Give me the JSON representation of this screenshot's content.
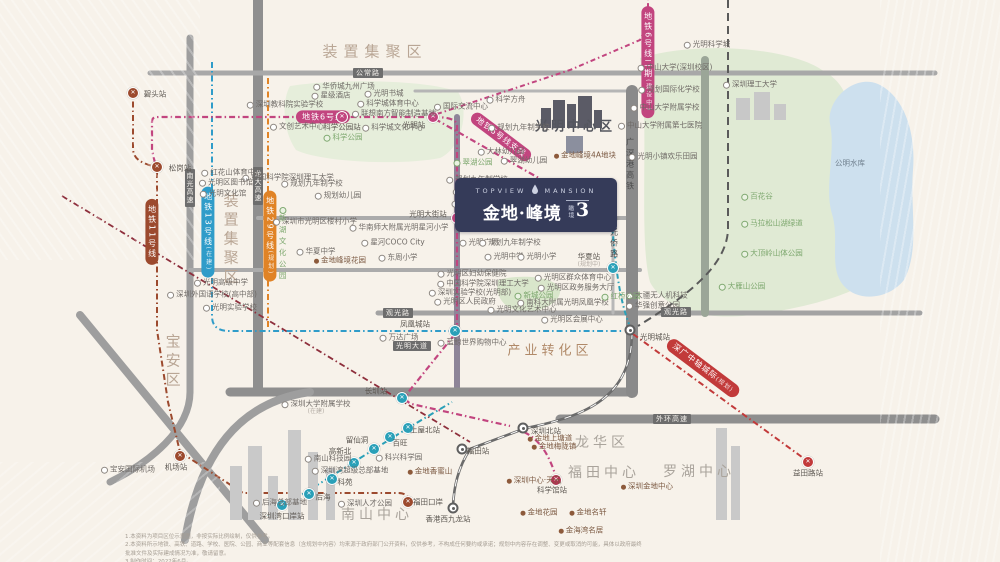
{
  "palette": {
    "background": "#f7f2ea",
    "green": "#e0ead4",
    "lake": "#cde0ee",
    "road": "#a0a0a0",
    "line6_pink": "#c2457f",
    "line13_blue": "#2f9cc9",
    "line29_orange": "#e08326",
    "line11_brown": "#9c4a2e",
    "teal": "#2aa0b8",
    "city_rail_red": "#c23a3a",
    "dark_red": "#8e2f3c",
    "rail_gray": "#6b6b6b",
    "logo_navy": "#353b59"
  },
  "logo": {
    "en_left": "TOPVIEW",
    "en_right": "MANSION",
    "cn": "金地·峰境",
    "badge_small": "瞰境",
    "badge_number": "3",
    "droplet_icon": "water-drop"
  },
  "zones": [
    {
      "t": "装置集聚区",
      "x": 375,
      "y": 52,
      "cls": "zone"
    },
    {
      "t": "装置集聚区",
      "x": 230,
      "y": 240,
      "cls": "zone zone-v"
    },
    {
      "t": "宝安区",
      "x": 172,
      "y": 362,
      "cls": "zone zone-v"
    },
    {
      "t": "光明中心区",
      "x": 575,
      "y": 128,
      "cls": "cbd"
    },
    {
      "t": "产业转化区",
      "x": 550,
      "y": 352,
      "cls": "indus"
    },
    {
      "t": "南山中心",
      "x": 377,
      "y": 515,
      "cls": "district"
    },
    {
      "t": "龙华区",
      "x": 602,
      "y": 443,
      "cls": "district"
    },
    {
      "t": "福田中心",
      "x": 604,
      "y": 473,
      "cls": "district"
    },
    {
      "t": "罗湖中心",
      "x": 699,
      "y": 472,
      "cls": "district"
    }
  ],
  "capsules": [
    {
      "t": "地铁6号线",
      "x": 323,
      "y": 117,
      "c": "#c2457f",
      "rot": 0,
      "v": false,
      "s": ""
    },
    {
      "t": "地铁6号线支线",
      "x": 501,
      "y": 137,
      "c": "#c2457f",
      "rot": 37,
      "v": false,
      "s": ""
    },
    {
      "t": "地铁6号线二期",
      "x": 648,
      "y": 62,
      "c": "#c2457f",
      "rot": 0,
      "v": true,
      "s": "(建设中)"
    },
    {
      "t": "地铁11号线",
      "x": 152,
      "y": 232,
      "c": "#9c4a2e",
      "rot": 0,
      "v": true,
      "s": ""
    },
    {
      "t": "地铁13号线",
      "x": 208,
      "y": 232,
      "c": "#2f9cc9",
      "rot": 0,
      "v": true,
      "s": "(在建)"
    },
    {
      "t": "地铁29号线",
      "x": 270,
      "y": 236,
      "c": "#e08326",
      "rot": 0,
      "v": true,
      "s": "(规划)"
    },
    {
      "t": "深广中轴城际",
      "x": 703,
      "y": 368,
      "c": "#c23a3a",
      "rot": 37,
      "v": false,
      "s": "(规划)"
    }
  ],
  "road_labels": [
    {
      "t": "公常路",
      "x": 368,
      "y": 73,
      "v": false
    },
    {
      "t": "南光高速",
      "x": 190,
      "y": 188,
      "v": true
    },
    {
      "t": "龙大高速",
      "x": 258,
      "y": 186,
      "v": true
    },
    {
      "t": "观光路",
      "x": 676,
      "y": 312,
      "v": false
    },
    {
      "t": "观光路",
      "x": 398,
      "y": 313,
      "v": false
    },
    {
      "t": "外环高速",
      "x": 672,
      "y": 419,
      "v": false
    },
    {
      "t": "光明大道",
      "x": 412,
      "y": 346,
      "v": false
    }
  ],
  "rail_texts": [
    {
      "t": "广深港高铁",
      "x": 630,
      "y": 165
    },
    {
      "t": "光侨路",
      "x": 614,
      "y": 244
    }
  ],
  "metro_stations": [
    {
      "t": "碧头站",
      "x": 133,
      "y": 93,
      "c": "#9c4a2e",
      "lx": 155,
      "ly": 95,
      "s": ""
    },
    {
      "t": "松岗站",
      "x": 157,
      "y": 167,
      "c": "#9c4a2e",
      "lx": 180,
      "ly": 169,
      "s": ""
    },
    {
      "t": "科学公园站",
      "x": 342,
      "y": 117,
      "c": "#c2457f",
      "lx": 342,
      "ly": 128,
      "s": ""
    },
    {
      "t": "光明站",
      "x": 433,
      "y": 117,
      "c": "#c2457f",
      "lx": 414,
      "ly": 126,
      "s": ""
    },
    {
      "t": "光明大街站",
      "x": 457,
      "y": 218,
      "c": "#c2457f",
      "lx": 428,
      "ly": 215,
      "s": ""
    },
    {
      "t": "光明小镇站",
      "x": 611,
      "y": 219,
      "c": "#c2457f",
      "lx": 584,
      "ly": 226,
      "s": "(规划中)"
    },
    {
      "t": "华夏站",
      "x": 613,
      "y": 268,
      "c": "#2aa0b8",
      "lx": 589,
      "ly": 261,
      "s": "(规划中)"
    },
    {
      "t": "凤凰城站",
      "x": 455,
      "y": 331,
      "c": "#2aa0b8",
      "lx": 415,
      "ly": 325,
      "s": ""
    },
    {
      "t": "长圳站",
      "x": 402,
      "y": 398,
      "c": "#2aa0b8",
      "lx": 376,
      "ly": 392,
      "s": ""
    },
    {
      "t": "深圳湾口岸站",
      "x": 282,
      "y": 505,
      "c": "#2aa0b8",
      "lx": 282,
      "ly": 517,
      "s": ""
    },
    {
      "t": "后海",
      "x": 309,
      "y": 494,
      "c": "#2aa0b8",
      "lx": 323,
      "ly": 498,
      "s": ""
    },
    {
      "t": "科苑",
      "x": 332,
      "y": 479,
      "c": "#2aa0b8",
      "lx": 345,
      "ly": 483,
      "s": ""
    },
    {
      "t": "高新北",
      "x": 354,
      "y": 463,
      "c": "#2aa0b8",
      "lx": 340,
      "ly": 452,
      "s": ""
    },
    {
      "t": "留仙洞",
      "x": 374,
      "y": 449,
      "c": "#2aa0b8",
      "lx": 357,
      "ly": 441,
      "s": ""
    },
    {
      "t": "百旺",
      "x": 390,
      "y": 437,
      "c": "#2aa0b8",
      "lx": 400,
      "ly": 444,
      "s": ""
    },
    {
      "t": "上屋北站",
      "x": 408,
      "y": 428,
      "c": "#2aa0b8",
      "lx": 425,
      "ly": 431,
      "s": ""
    },
    {
      "t": "科学馆站",
      "x": 556,
      "y": 480,
      "c": "#b03552",
      "lx": 552,
      "ly": 491,
      "s": ""
    },
    {
      "t": "机场站",
      "x": 180,
      "y": 456,
      "c": "#9c4a2e",
      "lx": 176,
      "ly": 468,
      "s": ""
    },
    {
      "t": "福田口岸",
      "x": 408,
      "y": 502,
      "c": "#9c4a2e",
      "lx": 428,
      "ly": 503,
      "s": ""
    },
    {
      "t": "益田路站",
      "x": 808,
      "y": 462,
      "c": "#c23a3a",
      "lx": 808,
      "ly": 474,
      "s": ""
    }
  ],
  "rail_stations": [
    {
      "t": "光明城站",
      "x": 630,
      "y": 330,
      "lx": 655,
      "ly": 338
    },
    {
      "t": "深圳北站",
      "x": 523,
      "y": 428,
      "lx": 546,
      "ly": 432
    },
    {
      "t": "福田站",
      "x": 462,
      "y": 449,
      "lx": 478,
      "ly": 452
    },
    {
      "t": "香港西九龙站",
      "x": 453,
      "y": 508,
      "lx": 448,
      "ly": 520
    }
  ],
  "pois": [
    {
      "t": "红花山体育中心",
      "x": 232,
      "y": 173
    },
    {
      "t": "深圳教科院实验学校",
      "x": 285,
      "y": 105
    },
    {
      "t": "星级酒店",
      "x": 331,
      "y": 96
    },
    {
      "t": "华侨城九州广场",
      "x": 344,
      "y": 87
    },
    {
      "t": "光明书城",
      "x": 384,
      "y": 94
    },
    {
      "t": "科学城体育中心",
      "x": 388,
      "y": 104
    },
    {
      "t": "联想南方智能制造基地",
      "x": 394,
      "y": 114
    },
    {
      "t": "文创艺术中心",
      "x": 297,
      "y": 127
    },
    {
      "t": "科学城文化中心",
      "x": 393,
      "y": 128
    },
    {
      "t": "中国科学院深圳理工大学",
      "x": 288,
      "y": 178
    },
    {
      "t": "规划九年制学校",
      "x": 312,
      "y": 184
    },
    {
      "t": "规划幼儿园",
      "x": 338,
      "y": 196
    },
    {
      "t": "光明区图书馆",
      "x": 226,
      "y": 183
    },
    {
      "t": "光明文化馆",
      "x": 223,
      "y": 194
    },
    {
      "t": "国际交流中心",
      "x": 461,
      "y": 107
    },
    {
      "t": "科学方舟",
      "x": 506,
      "y": 100
    },
    {
      "t": "规划九年制学校",
      "x": 519,
      "y": 128
    },
    {
      "t": "大林幼儿园",
      "x": 501,
      "y": 152
    },
    {
      "t": "翠湖幼儿园",
      "x": 524,
      "y": 161
    },
    {
      "t": "规划九年制学校",
      "x": 477,
      "y": 180
    },
    {
      "t": "光明招待所",
      "x": 476,
      "y": 192
    },
    {
      "t": "光明集团",
      "x": 471,
      "y": 204
    },
    {
      "t": "九年制公立学校",
      "x": 519,
      "y": 212,
      "s": "(规划中)"
    },
    {
      "t": "正大时代广场",
      "x": 487,
      "y": 227
    },
    {
      "t": "光明广场",
      "x": 479,
      "y": 243
    },
    {
      "t": "规划九年制学校",
      "x": 510,
      "y": 243
    },
    {
      "t": "光明中学",
      "x": 504,
      "y": 257
    },
    {
      "t": "光明小学",
      "x": 537,
      "y": 257
    },
    {
      "t": "光明区妇幼保健院",
      "x": 472,
      "y": 274
    },
    {
      "t": "中国科学院深圳理工大学",
      "x": 483,
      "y": 284
    },
    {
      "t": "深圳实验学校(光明部)",
      "x": 470,
      "y": 293
    },
    {
      "t": "光明区人民政府",
      "x": 465,
      "y": 302
    },
    {
      "t": "光明文化艺术中心",
      "x": 522,
      "y": 310
    },
    {
      "t": "光明区群众体育中心",
      "x": 573,
      "y": 278
    },
    {
      "t": "光明区政务服务大厅",
      "x": 576,
      "y": 288
    },
    {
      "t": "南科大附属光明凤凰学校",
      "x": 563,
      "y": 303
    },
    {
      "t": "光明区会展中心",
      "x": 572,
      "y": 320
    },
    {
      "t": "万达广场",
      "x": 399,
      "y": 338
    },
    {
      "t": "蓝鲸世界购物中心",
      "x": 472,
      "y": 343
    },
    {
      "t": "深圳大学附属学校",
      "x": 316,
      "y": 408,
      "s": "(在建)"
    },
    {
      "t": "华南师大附属光明星河小学",
      "x": 399,
      "y": 228
    },
    {
      "t": "星河COCO City",
      "x": 393,
      "y": 243
    },
    {
      "t": "东周小学",
      "x": 398,
      "y": 258
    },
    {
      "t": "深圳市光明区楼村小学",
      "x": 315,
      "y": 222
    },
    {
      "t": "华夏中学",
      "x": 316,
      "y": 252
    },
    {
      "t": "光明高级中学",
      "x": 221,
      "y": 283
    },
    {
      "t": "深圳外国语学校(高中部)",
      "x": 212,
      "y": 295
    },
    {
      "t": "光明实验学校",
      "x": 230,
      "y": 308
    },
    {
      "t": "中山大学(深圳校区)",
      "x": 675,
      "y": 68
    },
    {
      "t": "光明科学城",
      "x": 707,
      "y": 45
    },
    {
      "t": "规划国际化学校",
      "x": 669,
      "y": 90
    },
    {
      "t": "中山大学附属学校",
      "x": 665,
      "y": 108
    },
    {
      "t": "中山大学附属第七医院",
      "x": 660,
      "y": 126
    },
    {
      "t": "深圳理工大学",
      "x": 750,
      "y": 85
    },
    {
      "t": "大疆无人机科技",
      "x": 657,
      "y": 296
    },
    {
      "t": "华强创意公园",
      "x": 653,
      "y": 306
    },
    {
      "t": "光明小镇欢乐田园",
      "x": 663,
      "y": 157
    },
    {
      "t": "南山科技园",
      "x": 328,
      "y": 459
    },
    {
      "t": "深圳湾超级总部基地",
      "x": 350,
      "y": 471
    },
    {
      "t": "科兴科学园",
      "x": 399,
      "y": 458
    },
    {
      "t": "后海总部基地",
      "x": 280,
      "y": 503
    },
    {
      "t": "深圳人才公园",
      "x": 365,
      "y": 504
    },
    {
      "t": "宝安国际机场",
      "x": 128,
      "y": 470
    }
  ],
  "parks": [
    {
      "t": "翠湖公园",
      "x": 473,
      "y": 163
    },
    {
      "t": "科学公园",
      "x": 343,
      "y": 138
    },
    {
      "t": "新城公园",
      "x": 534,
      "y": 296
    },
    {
      "t": "红桥公园",
      "x": 621,
      "y": 297
    },
    {
      "t": "新湖文化公园",
      "x": 283,
      "y": 245,
      "v": true
    },
    {
      "t": "百花谷",
      "x": 757,
      "y": 197
    },
    {
      "t": "马拉松山湖绿道",
      "x": 772,
      "y": 224
    },
    {
      "t": "大顶岭山体公园",
      "x": 772,
      "y": 254
    },
    {
      "t": "大雁山公园",
      "x": 742,
      "y": 287
    }
  ],
  "lake_label": {
    "t": "公明水库",
    "x": 850,
    "y": 164
  },
  "projects": [
    {
      "t": "金地峰境4A地块",
      "x": 585,
      "y": 156
    },
    {
      "t": "金地峰境花园",
      "x": 340,
      "y": 261
    },
    {
      "t": "金地上塘道",
      "x": 550,
      "y": 439
    },
    {
      "t": "金地梅陇镇",
      "x": 554,
      "y": 447
    },
    {
      "t": "深圳中心·天元",
      "x": 534,
      "y": 481
    },
    {
      "t": "深圳金地中心",
      "x": 647,
      "y": 487
    },
    {
      "t": "金地花园",
      "x": 539,
      "y": 513
    },
    {
      "t": "金地名轩",
      "x": 588,
      "y": 513
    },
    {
      "t": "金海湾名居",
      "x": 581,
      "y": 531
    },
    {
      "t": "金地香蜜山",
      "x": 430,
      "y": 472
    }
  ],
  "disclaimer": {
    "line1": "1.本资料为项目区位示意图，非按实际比例绘制，仅供参考。",
    "line2": "2.本资料所示地铁、高铁、道路、学校、医院、公园、商业等配套信息（含规划中内容）均来源于政府部门公开资料，仅供参考，不构成任何要约或承诺；规划中内容存在调整、变更或取消的可能，具体以政府最终批准文件及实际建成情况为准，敬请留意。",
    "line3": "3.制作时间：2022年6月。"
  }
}
